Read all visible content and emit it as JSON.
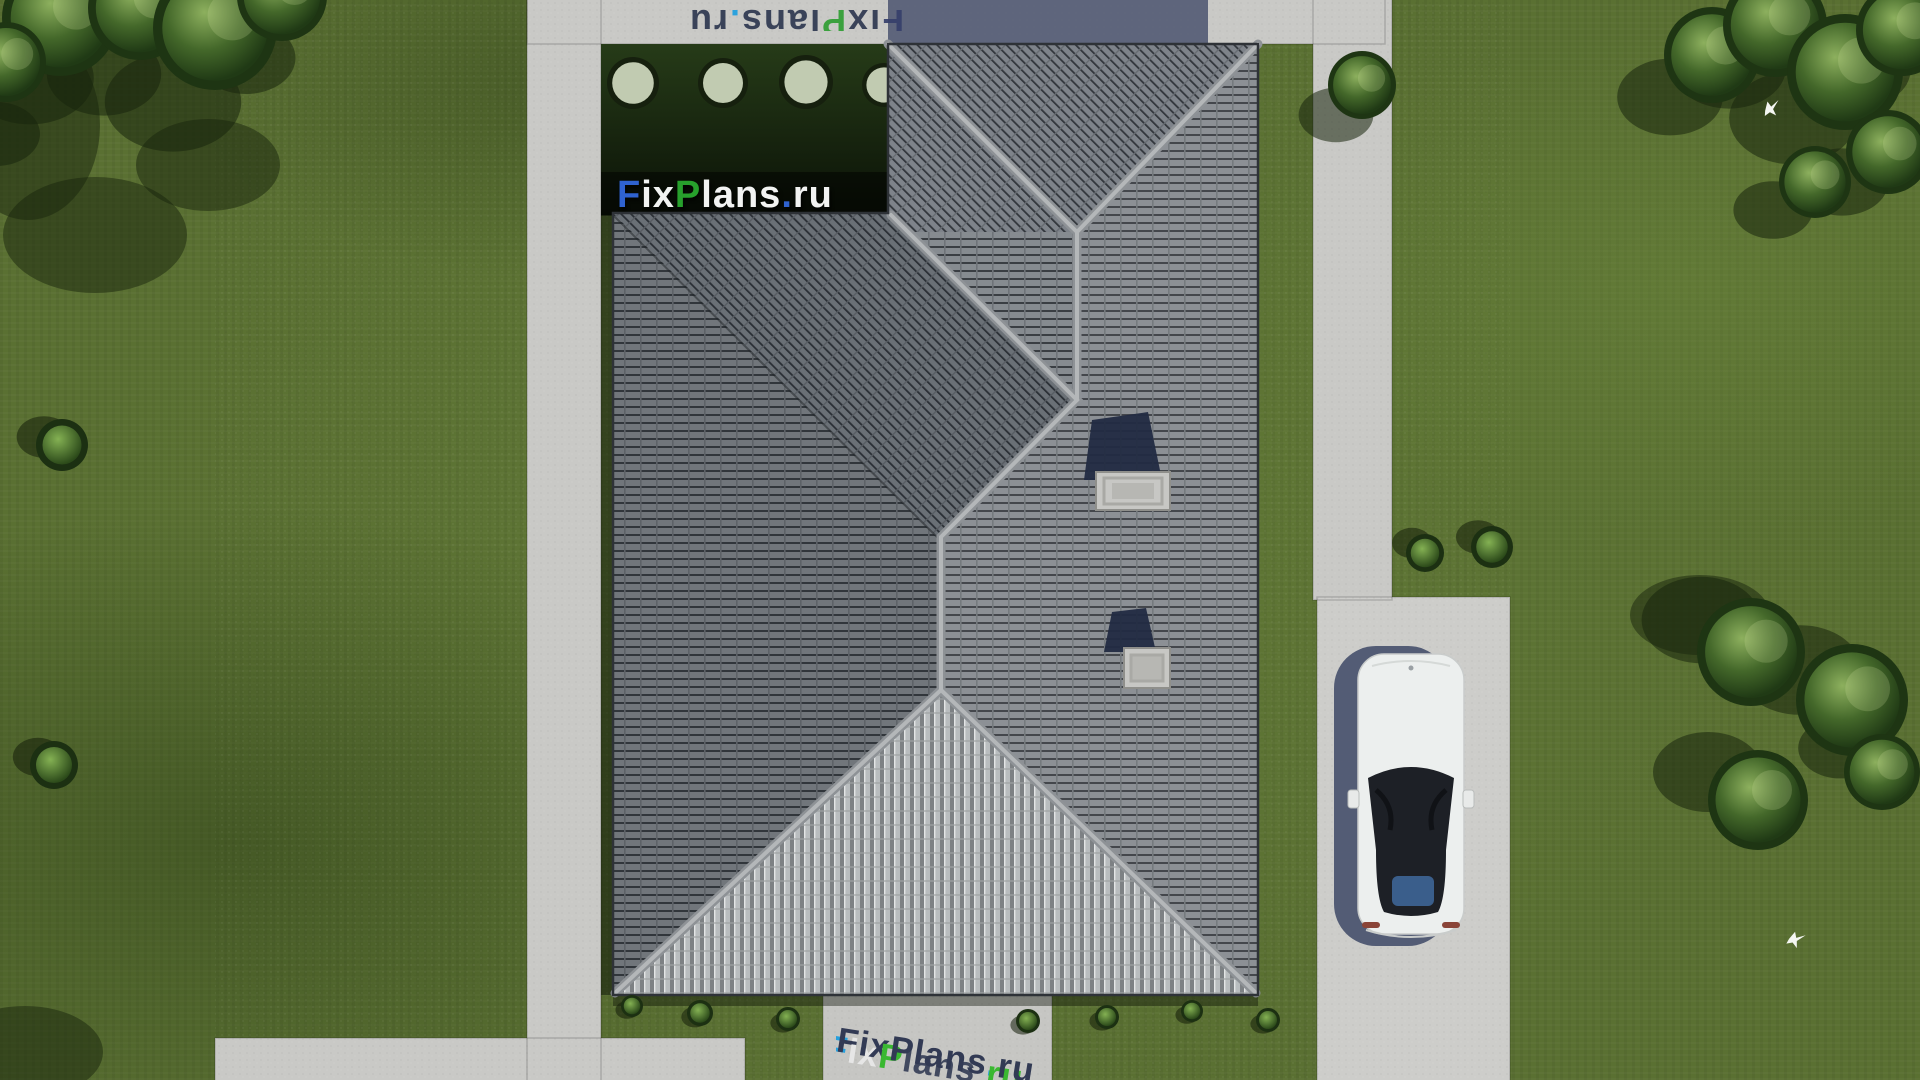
{
  "scene": {
    "description": "Aerial top-down 3D render of a hip-roof house plan on a lawn with concrete walkways, driveway and a white car",
    "colors": {
      "grass": "#5a7032",
      "path_concrete": "#c9c9c6",
      "path_shadow": "#596078",
      "roof_tile_light": "#868b90",
      "roof_tile_line": "#3a3e43",
      "roof_ridge": "#b4b7b9",
      "roof_hip_face": "#b9bdbf",
      "garden_shadow_dark": "#0c1408",
      "tree_dark": "#203a15",
      "tree_light": "#8db05e",
      "car_body": "#ecefee",
      "car_glass": "#1d2026",
      "car_shadow": "#46506b",
      "chimney_cap": "#c7c7c4",
      "logo_blue": "#2f62cf",
      "logo_green": "#27a02c",
      "logo_white": "#f2f3f2",
      "watermark_navy": "#2c3550",
      "watermark_bright_blue": "#1f9fe0",
      "watermark_bright_green": "#35b82c"
    }
  },
  "watermark": {
    "brand": "FixPlans.ru",
    "segments": [
      "F",
      "ix",
      "P",
      "lans",
      ".",
      "ru"
    ],
    "instances": [
      {
        "target": "wm-main",
        "palette": [
          "#2f62cf",
          "#f2f3f2",
          "#27a02c",
          "#f2f3f2",
          "#2f62cf",
          "#f2f3f2"
        ],
        "shadows": null
      },
      {
        "target": "wm-top",
        "palette": [
          "#36406b",
          "#2e3850",
          "#2f9e33",
          "#2e3850",
          "#1f9fe0",
          "#2e3850"
        ],
        "shadows": null
      },
      {
        "target": "wm-bottom",
        "palette": [
          "#2c3550",
          "#2c3550",
          "#2c3550",
          "#2c3550",
          "#1f9fe0",
          "#2c3550"
        ],
        "shadows": [
          "#1f9fe0",
          "#e8e8e8",
          "#35b82c",
          "rgba(44,53,80,0.9)",
          "none",
          "#35b82c"
        ]
      }
    ]
  },
  "trees": [
    {
      "x": 60,
      "y": 18,
      "r": 58,
      "sdx": -30,
      "sdy": 60
    },
    {
      "x": 140,
      "y": 8,
      "r": 52,
      "sdx": -36,
      "sdy": 66
    },
    {
      "x": 215,
      "y": 28,
      "r": 62,
      "sdx": -42,
      "sdy": 74
    },
    {
      "x": 282,
      "y": -4,
      "r": 45,
      "sdx": -36,
      "sdy": 62
    },
    {
      "x": 6,
      "y": 62,
      "r": 40,
      "sdx": -10,
      "sdy": 72
    },
    {
      "x": 1362,
      "y": 85,
      "r": 34,
      "sdx": -26,
      "sdy": 30
    },
    {
      "x": 1712,
      "y": 55,
      "r": 48,
      "sdx": -42,
      "sdy": 42
    },
    {
      "x": 1775,
      "y": 25,
      "r": 52,
      "sdx": -46,
      "sdy": 42
    },
    {
      "x": 1845,
      "y": 72,
      "r": 58,
      "sdx": -52,
      "sdy": 46
    },
    {
      "x": 1902,
      "y": 30,
      "r": 46,
      "sdx": -42,
      "sdy": 40
    },
    {
      "x": 1888,
      "y": 152,
      "r": 42,
      "sdx": -46,
      "sdy": 30
    },
    {
      "x": 1815,
      "y": 182,
      "r": 36,
      "sdx": -42,
      "sdy": 28
    },
    {
      "x": 1751,
      "y": 652,
      "r": 54,
      "sdx": -50,
      "sdy": -32
    },
    {
      "x": 1852,
      "y": 700,
      "r": 56,
      "sdx": -52,
      "sdy": -30
    },
    {
      "x": 1758,
      "y": 800,
      "r": 50,
      "sdx": -50,
      "sdy": -28
    },
    {
      "x": 1882,
      "y": 772,
      "r": 38,
      "sdx": -42,
      "sdy": -24
    }
  ],
  "shadow_blobs": [
    {
      "x": 95,
      "y": 235,
      "rx": 92,
      "ry": 58
    },
    {
      "x": 28,
      "y": 125,
      "rx": 72,
      "ry": 95
    },
    {
      "x": 208,
      "y": 165,
      "rx": 72,
      "ry": 46
    },
    {
      "x": 25,
      "y": 1052,
      "rx": 78,
      "ry": 46
    },
    {
      "x": 1700,
      "y": 615,
      "rx": 70,
      "ry": 40
    }
  ],
  "garden_bushes": [
    {
      "x": 633,
      "y": 83,
      "r": 26
    },
    {
      "x": 723,
      "y": 83,
      "r": 25
    },
    {
      "x": 806,
      "y": 82,
      "r": 27
    },
    {
      "x": 884,
      "y": 85,
      "r": 22
    }
  ],
  "bushes": [
    {
      "x": 1425,
      "y": 553,
      "r": 19,
      "sdx": -13,
      "sdy": -10
    },
    {
      "x": 1492,
      "y": 547,
      "r": 21,
      "sdx": -14,
      "sdy": -10
    },
    {
      "x": 62,
      "y": 445,
      "r": 26,
      "sdx": -18,
      "sdy": -8
    },
    {
      "x": 54,
      "y": 765,
      "r": 24,
      "sdx": -16,
      "sdy": -8
    },
    {
      "x": 632,
      "y": 1006,
      "r": 11,
      "sdx": -5,
      "sdy": 4
    },
    {
      "x": 700,
      "y": 1013,
      "r": 13,
      "sdx": -5,
      "sdy": 4
    },
    {
      "x": 788,
      "y": 1019,
      "r": 12,
      "sdx": -5,
      "sdy": 4
    },
    {
      "x": 1028,
      "y": 1021,
      "r": 12,
      "sdx": -5,
      "sdy": 4
    },
    {
      "x": 1107,
      "y": 1017,
      "r": 12,
      "sdx": -5,
      "sdy": 4
    },
    {
      "x": 1192,
      "y": 1011,
      "r": 11,
      "sdx": -5,
      "sdy": 4
    },
    {
      "x": 1268,
      "y": 1020,
      "r": 12,
      "sdx": -5,
      "sdy": 4
    }
  ],
  "birds": [
    {
      "x": 1763,
      "y": 104,
      "rot": -18
    },
    {
      "x": 1790,
      "y": 932,
      "rot": 8
    }
  ]
}
